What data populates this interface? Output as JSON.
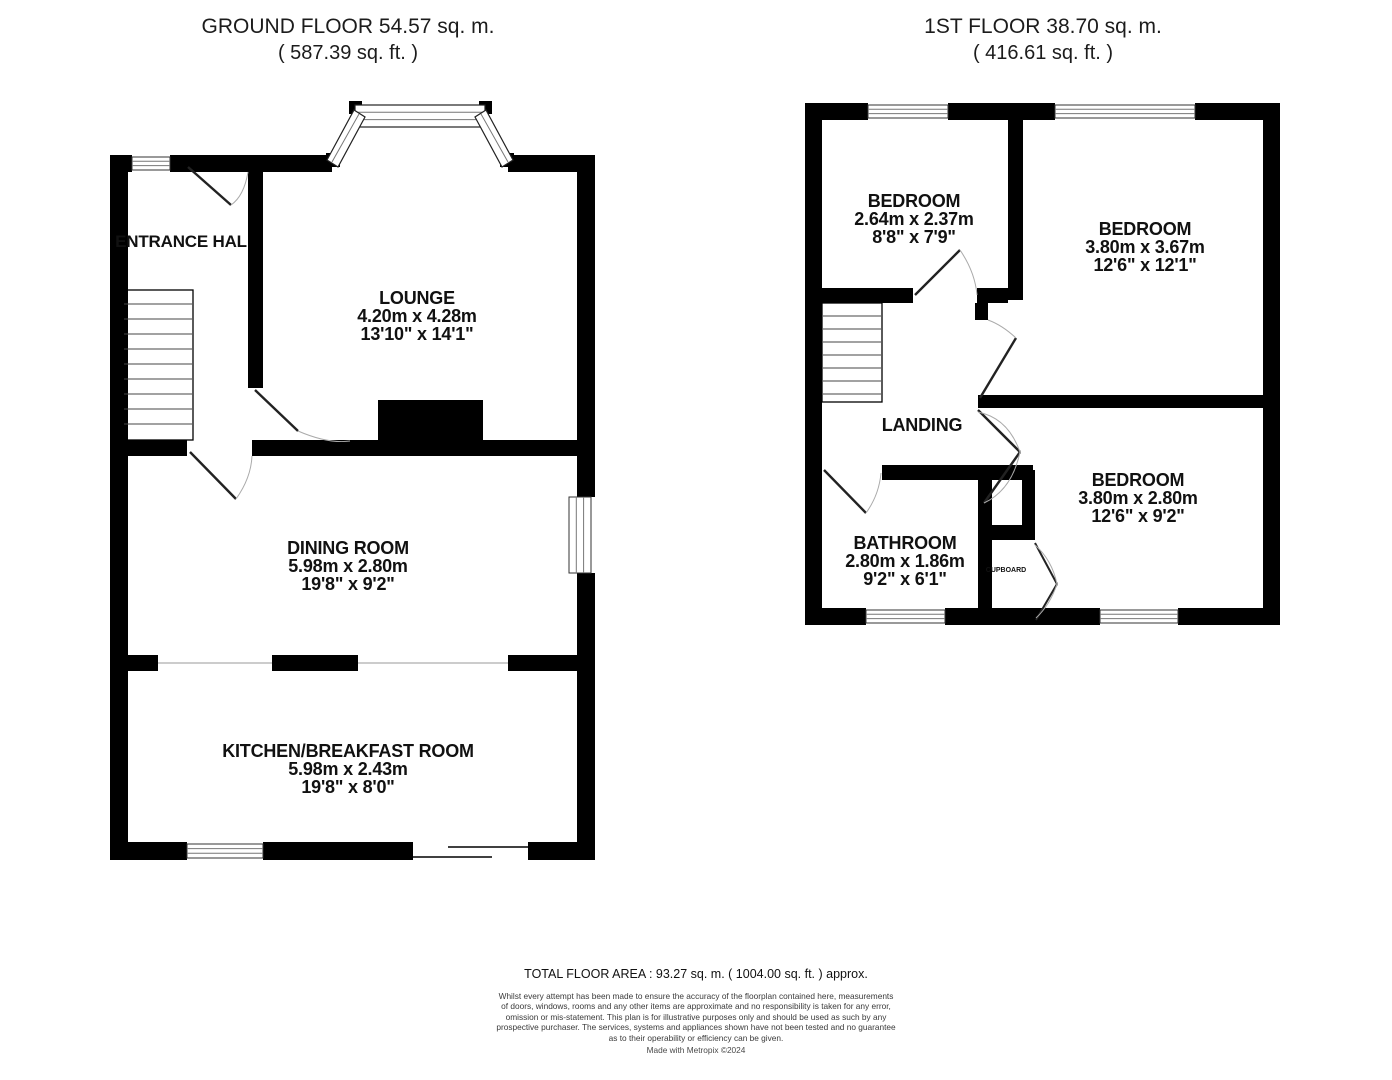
{
  "ground_floor": {
    "title": "GROUND FLOOR 54.57 sq. m.",
    "subtitle": "( 587.39 sq. ft. )",
    "rooms": {
      "entrance_hall": {
        "name": "ENTRANCE HAL"
      },
      "lounge": {
        "name": "LOUNGE",
        "dim_metric": "4.20m x 4.28m",
        "dim_imperial": "13'10\" x 14'1\""
      },
      "dining_room": {
        "name": "DINING ROOM",
        "dim_metric": "5.98m x 2.80m",
        "dim_imperial": "19'8\" x 9'2\""
      },
      "kitchen": {
        "name": "KITCHEN/BREAKFAST ROOM",
        "dim_metric": "5.98m x 2.43m",
        "dim_imperial": "19'8\" x 8'0\""
      }
    }
  },
  "first_floor": {
    "title": "1ST FLOOR 38.70 sq. m.",
    "subtitle": "( 416.61 sq. ft. )",
    "rooms": {
      "bedroom_1": {
        "name": "BEDROOM",
        "dim_metric": "2.64m x 2.37m",
        "dim_imperial": "8'8\" x 7'9\""
      },
      "bedroom_2": {
        "name": "BEDROOM",
        "dim_metric": "3.80m x 3.67m",
        "dim_imperial": "12'6\" x 12'1\""
      },
      "bedroom_3": {
        "name": "BEDROOM",
        "dim_metric": "3.80m x 2.80m",
        "dim_imperial": "12'6\" x 9'2\""
      },
      "landing": {
        "name": "LANDING"
      },
      "bathroom": {
        "name": "BATHROOM",
        "dim_metric": "2.80m x 1.86m",
        "dim_imperial": "9'2\" x 6'1\""
      },
      "cupboard": {
        "name": "CUPBOARD"
      }
    }
  },
  "footer": {
    "total_area": "TOTAL FLOOR AREA : 93.27 sq. m. ( 1004.00 sq. ft. ) approx.",
    "disclaimer_lines": [
      "Whilst every attempt has been made to ensure the accuracy of the floorplan contained here, measurements",
      "of doors, windows, rooms and any other items are approximate and no responsibility is taken for any error,",
      "omission or mis-statement. This plan is for illustrative purposes only and should be used as such by any",
      "prospective purchaser. The services, systems and appliances shown have not been tested and no guarantee",
      "as to their operability or efficiency can be given."
    ],
    "credit": "Made with Metropix ©2024"
  },
  "colors": {
    "wall": "#000000",
    "background": "#ffffff",
    "window_line": "#777777"
  }
}
